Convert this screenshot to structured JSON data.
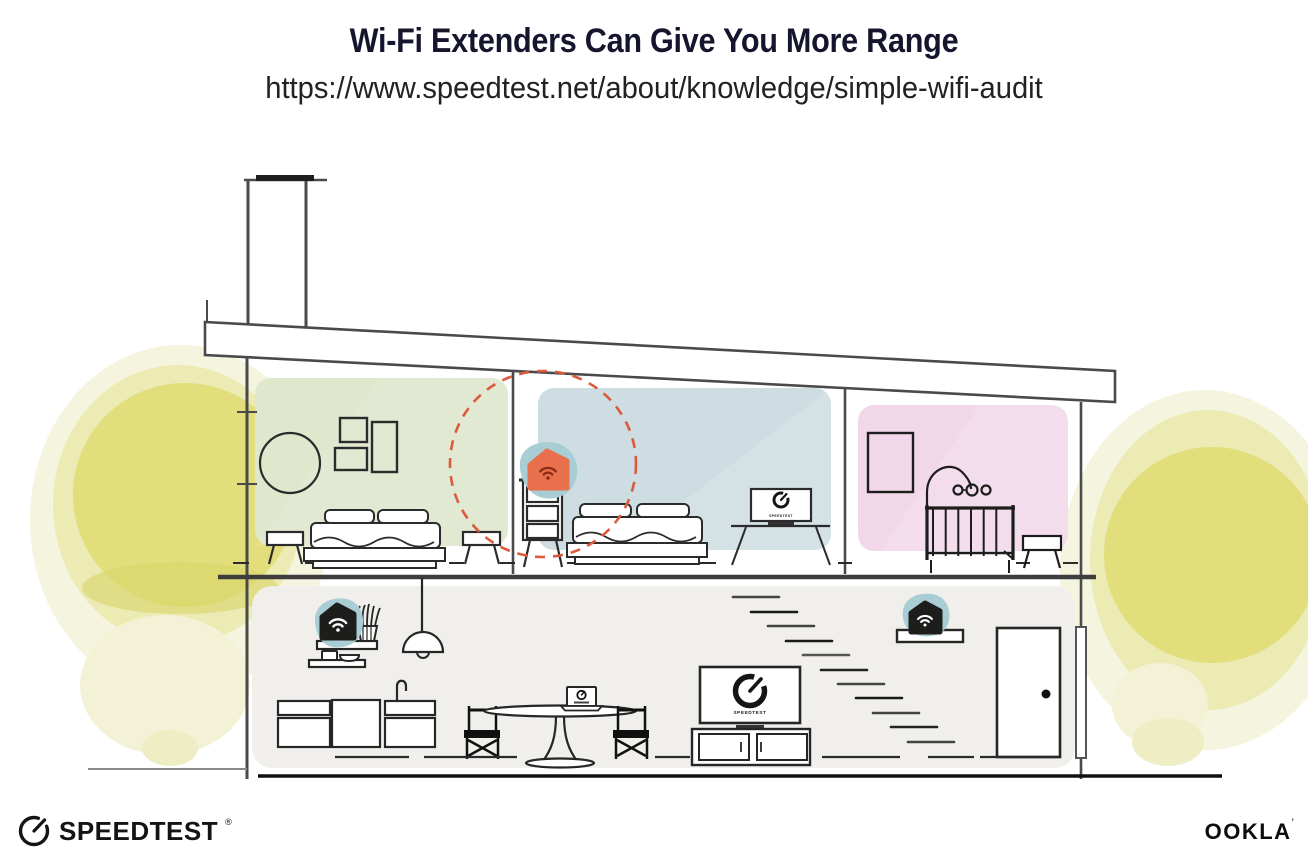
{
  "page": {
    "title": "Wi-Fi Extenders Can Give You More Range",
    "url": "https://www.speedtest.net/about/knowledge/simple-wifi-audit"
  },
  "footer": {
    "speedtest_logo": {
      "label": "SPEEDTEST",
      "trademark": "®",
      "icon": "speedtest-gauge-icon"
    },
    "ookla_logo": {
      "label": "OOKLA",
      "trademark": "’"
    }
  },
  "illustration": {
    "type": "house-cross-section",
    "tv_screen_label": "SPEEDTEST",
    "colors": {
      "room_green": "#dfe7cd",
      "room_blue": "#cddde1",
      "room_pink": "#f2d7e9",
      "lower_floor": "#f0efec",
      "device_halo_teal": "#a9cdd5",
      "extender_orange": "#e8704d",
      "extender_wifi_glyph": "#8b2b16",
      "router_black": "#1d1d1b",
      "coverage_circle": "#dc5a3c",
      "foliage_yellow": "#e1de7b",
      "line_art": "#262626",
      "structure_gray": "#4a4a4a"
    },
    "devices": [
      {
        "name": "wifi-extender-on-dresser",
        "location": "upper middle bedroom",
        "highlighted": true
      },
      {
        "name": "wifi-router-on-shelf",
        "location": "lower floor left"
      },
      {
        "name": "wifi-extender-by-stairs",
        "location": "lower floor right"
      }
    ],
    "rooms": [
      {
        "name": "bedroom-left",
        "floor": "upper"
      },
      {
        "name": "bedroom-middle",
        "floor": "upper"
      },
      {
        "name": "nursery-right",
        "floor": "upper"
      },
      {
        "name": "living-kitchen-area",
        "floor": "lower"
      }
    ]
  }
}
